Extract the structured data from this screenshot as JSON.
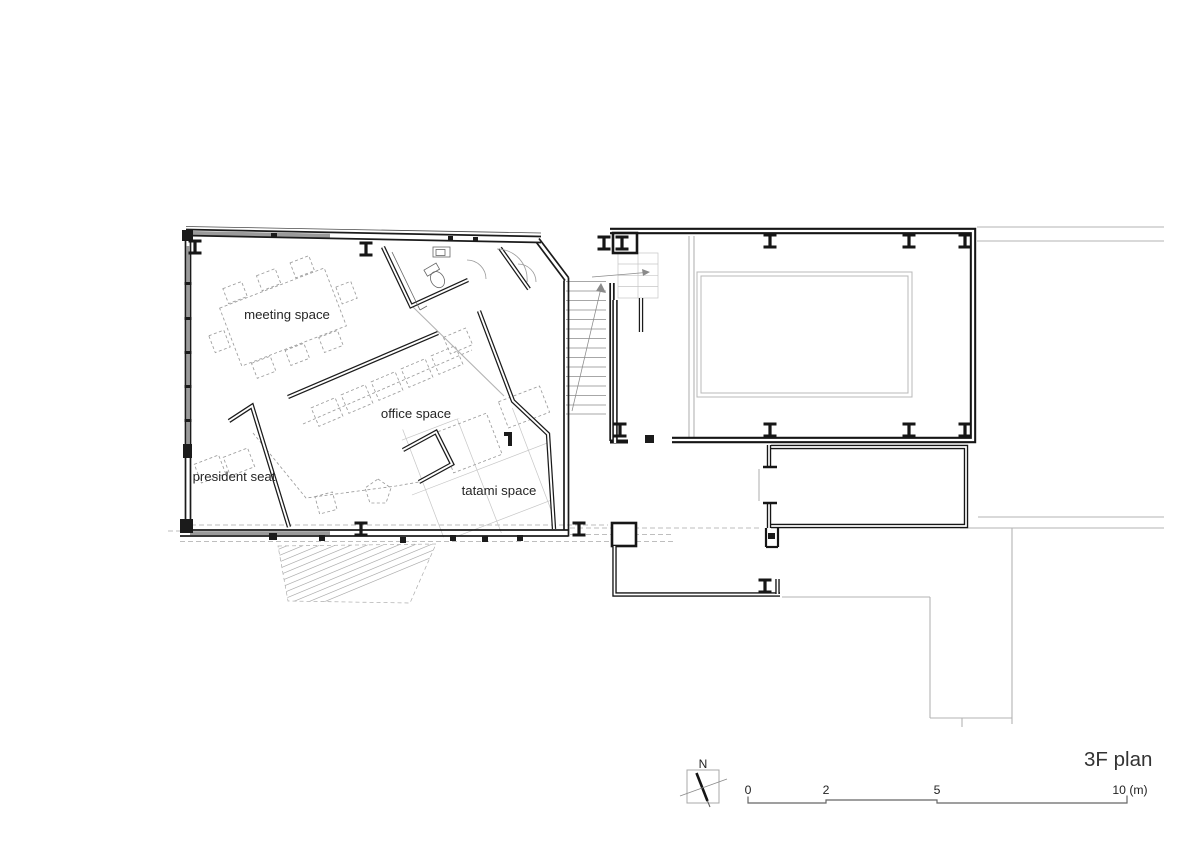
{
  "plan": {
    "title": "3F plan",
    "rooms": {
      "meeting": "meeting space",
      "office": "office space",
      "president": "president seat",
      "tatami": "tatami space"
    },
    "north_label": "N",
    "scale": {
      "t0": "0",
      "t2": "2",
      "t5": "5",
      "t10": "10 (m)"
    }
  },
  "colors": {
    "wall": "#1b1b1b",
    "context": "#b3b3b3",
    "furniture_dash": "#9c9c9c",
    "glazing": "#9a9a9a",
    "text": "#262626"
  }
}
